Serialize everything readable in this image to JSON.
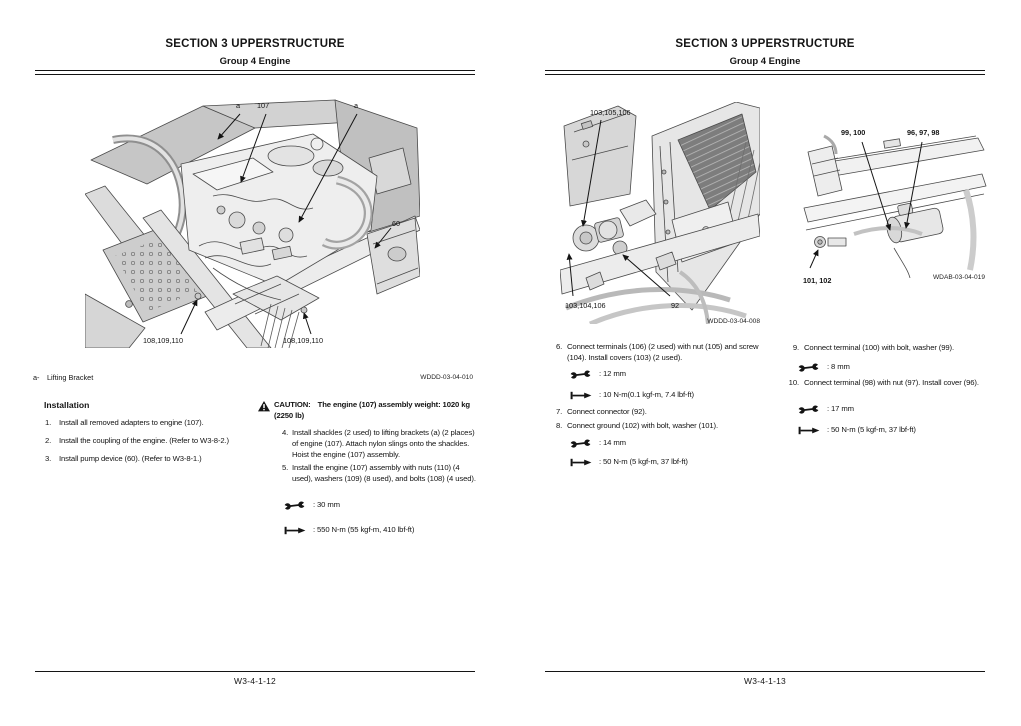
{
  "theme": {
    "paper": "#ffffff",
    "ink": "#141414"
  },
  "icons": {
    "warning": "warning-triangle-icon",
    "wrench": "wrench-icon",
    "torque": "torque-wrench-icon"
  },
  "left_page": {
    "header_title": "SECTION 3 UPPERSTRUCTURE",
    "header_subtitle": "Group 4 Engine",
    "figure": {
      "caption": "WDDD-03-04-010",
      "labels": {
        "a_top": "a",
        "part_107": "107",
        "a_right": "a",
        "part_60": "60",
        "bolts_left": "108,109,110",
        "bolts_right": "108,109,110"
      }
    },
    "legend_key": "a-",
    "legend_value": "Lifting Bracket",
    "installation_heading": "Installation",
    "steps": [
      {
        "num": "1.",
        "text": "Install all removed adapters to engine (107)."
      },
      {
        "num": "2.",
        "text": "Install the coupling of the engine. (Refer to W3-8-2.)"
      },
      {
        "num": "3.",
        "text": "Install pump device (60). (Refer to W3-8-1.)"
      }
    ],
    "caution_label": "CAUTION:",
    "caution_text": "The engine (107) assembly weight: 1020 kg (2250 lb)",
    "steps_right": [
      {
        "num": "4.",
        "text": "Install shackles (2 used) to lifting brackets (a) (2 places) of engine (107). Attach nylon slings onto the shackles. Hoist the engine (107) assembly."
      },
      {
        "num": "5.",
        "text": "Install the engine (107) assembly with nuts (110) (4 used), washers (109) (8 used), and bolts (108) (4 used)."
      }
    ],
    "spec_wrench": ": 30 mm",
    "spec_torque": ": 550 N-m (55 kgf-m, 410 lbf-ft)",
    "page_number": "W3-4-1-12"
  },
  "right_page": {
    "header_title": "SECTION 3 UPPERSTRUCTURE",
    "header_subtitle": "Group 4 Engine",
    "figure_terminals": {
      "caption": "WDDD-03-04-008",
      "labels": {
        "top": "103,105,106",
        "bottom_left": "103,104,106",
        "bottom_right": "92"
      }
    },
    "figure_starter": {
      "caption": "WDAB-03-04-019",
      "labels": {
        "top_left": "99, 100",
        "top_right": "96, 97, 98",
        "bottom_left": "101, 102"
      }
    },
    "steps_col1": [
      {
        "num": "6.",
        "text": "Connect terminals (106) (2 used) with nut (105) and screw (104). Install covers (103) (2 used)."
      },
      {
        "num": "7.",
        "text": "Connect connector (92)."
      },
      {
        "num": "8.",
        "text": "Connect ground (102) with bolt, washer (101)."
      }
    ],
    "spec6_wrench": ": 12 mm",
    "spec6_torque": ": 10 N-m(0.1 kgf-m, 7.4 lbf-ft)",
    "spec8_wrench": ": 14 mm",
    "spec8_torque": ": 50 N-m (5 kgf-m, 37 lbf-ft)",
    "steps_col2": [
      {
        "num": "9.",
        "text": "Connect terminal (100) with bolt, washer (99)."
      },
      {
        "num": "10.",
        "text": "Connect terminal (98) with nut (97). Install cover (96)."
      }
    ],
    "spec9_wrench": ": 8 mm",
    "spec10_wrench": ": 17 mm",
    "spec10_torque": ": 50 N-m (5 kgf-m, 37 lbf-ft)",
    "page_number": "W3-4-1-13"
  }
}
